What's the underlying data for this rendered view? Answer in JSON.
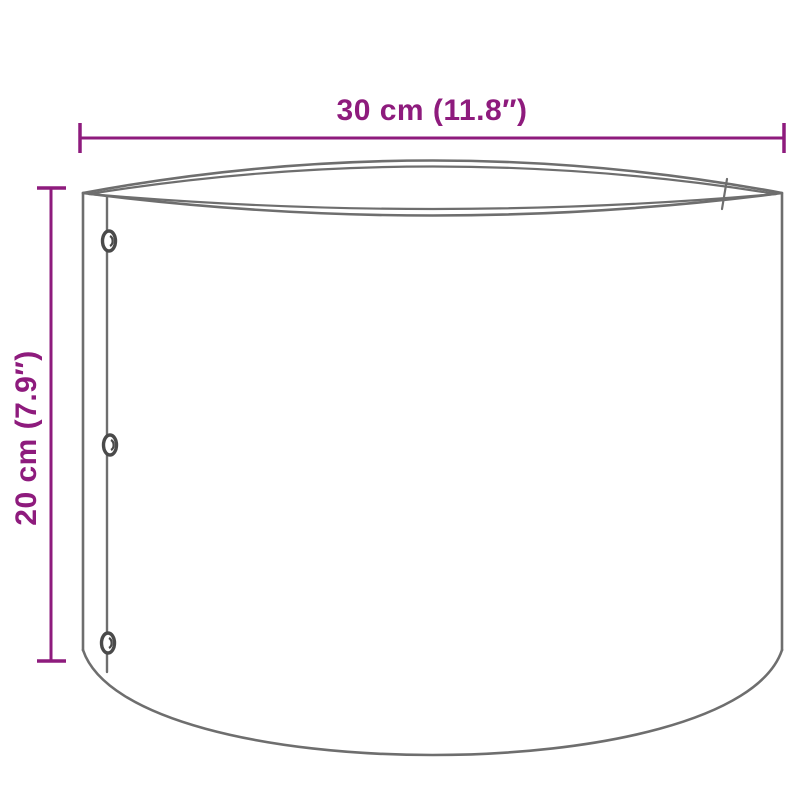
{
  "diagram": {
    "subject": "cylindrical-planter-dimension-drawing",
    "dimensions": {
      "width": {
        "label": "30 cm (11.8″)",
        "value_cm": 30,
        "value_in": 11.8
      },
      "height": {
        "label": "20 cm (7.9″)",
        "value_cm": 20,
        "value_in": 7.9
      }
    },
    "colors": {
      "dimension_accent": "#8e1b7d",
      "outline_gray": "#6e6e6e",
      "rivet_gray": "#4a4a4a",
      "background": "#ffffff"
    },
    "features": {
      "rivet_count": 3,
      "seam": "riveted vertical seam on left, overlap edge visible at rear right"
    }
  }
}
